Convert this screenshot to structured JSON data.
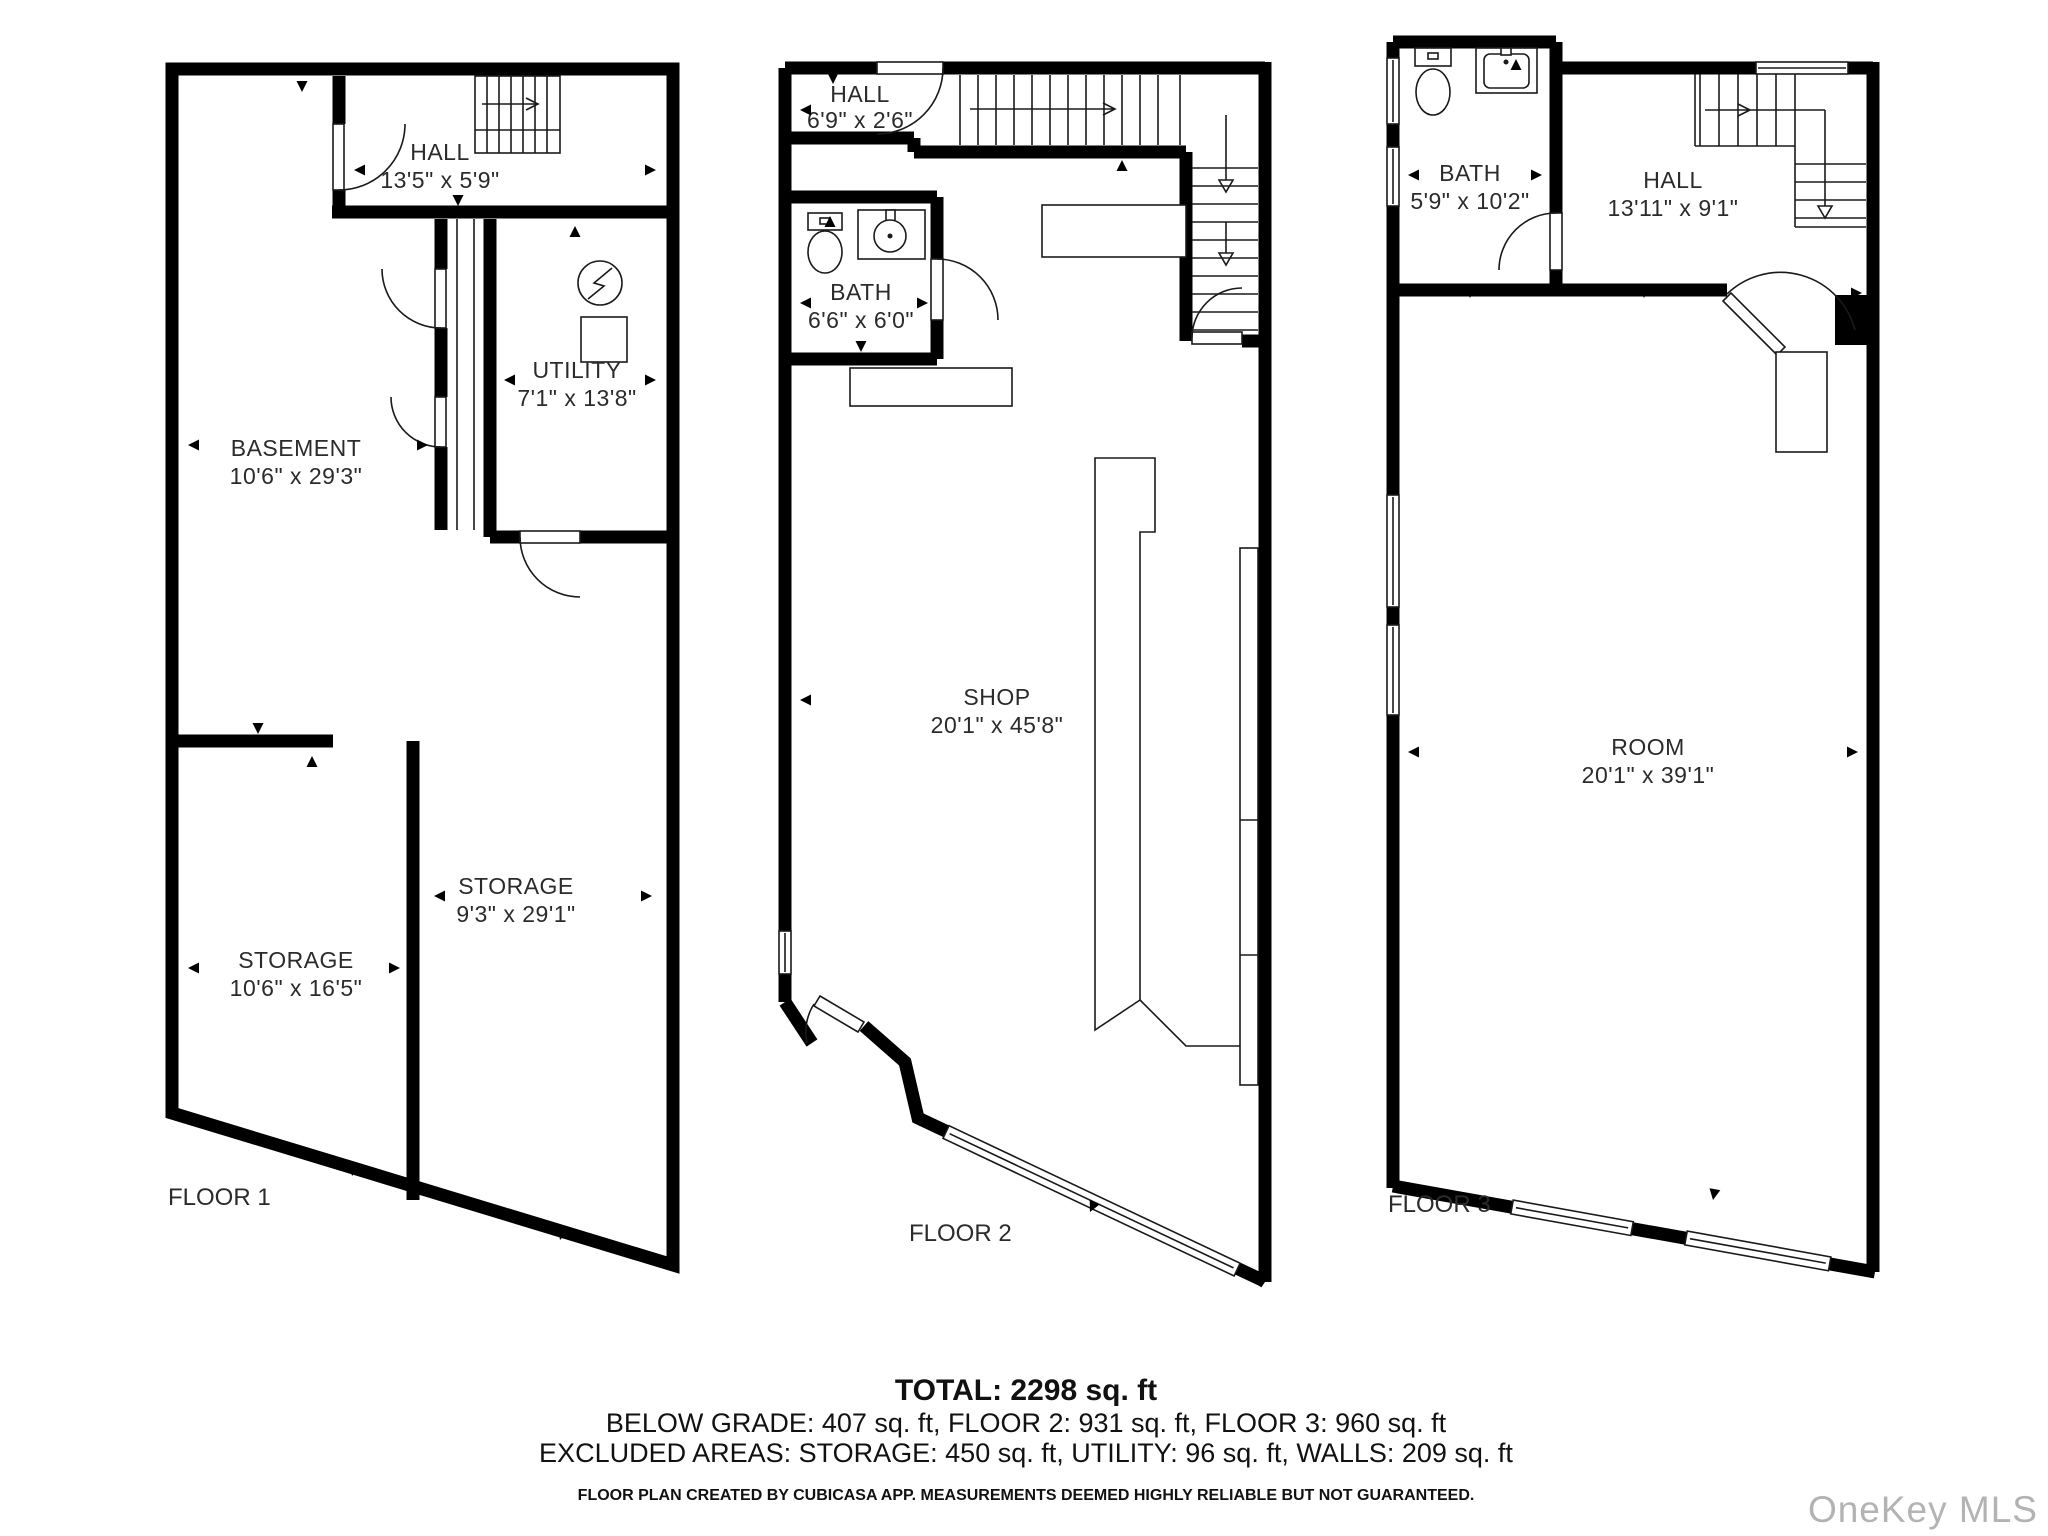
{
  "floors": [
    {
      "label": "FLOOR 1",
      "rooms": [
        {
          "name": "HALL",
          "dims": "13'5\" x 5'9\""
        },
        {
          "name": "BASEMENT",
          "dims": "10'6\" x 29'3\""
        },
        {
          "name": "UTILITY",
          "dims": "7'1\" x 13'8\""
        },
        {
          "name": "STORAGE",
          "dims": "10'6\" x 16'5\""
        },
        {
          "name": "STORAGE",
          "dims": "9'3\" x 29'1\""
        }
      ]
    },
    {
      "label": "FLOOR 2",
      "rooms": [
        {
          "name": "HALL",
          "dims": "6'9\" x 2'6\""
        },
        {
          "name": "BATH",
          "dims": "6'6\" x 6'0\""
        },
        {
          "name": "SHOP",
          "dims": "20'1\" x 45'8\""
        }
      ]
    },
    {
      "label": "FLOOR 3",
      "rooms": [
        {
          "name": "BATH",
          "dims": "5'9\" x 10'2\""
        },
        {
          "name": "HALL",
          "dims": "13'11\" x 9'1\""
        },
        {
          "name": "ROOM",
          "dims": "20'1\" x 39'1\""
        }
      ]
    }
  ],
  "summary": {
    "total": "TOTAL: 2298 sq. ft",
    "breakdown": "BELOW GRADE: 407 sq. ft, FLOOR 2: 931 sq. ft, FLOOR 3: 960 sq. ft",
    "excluded": "EXCLUDED AREAS: STORAGE: 450 sq. ft, UTILITY: 96 sq. ft, WALLS: 209 sq. ft",
    "disclaimer": "FLOOR PLAN CREATED BY CUBICASA APP. MEASUREMENTS DEEMED HIGHLY RELIABLE BUT NOT GUARANTEED."
  },
  "watermark": "OneKey MLS",
  "colors": {
    "walls": "#000000",
    "background": "#ffffff",
    "watermark": "#b3b3b3",
    "text": "#2b2b2b"
  }
}
